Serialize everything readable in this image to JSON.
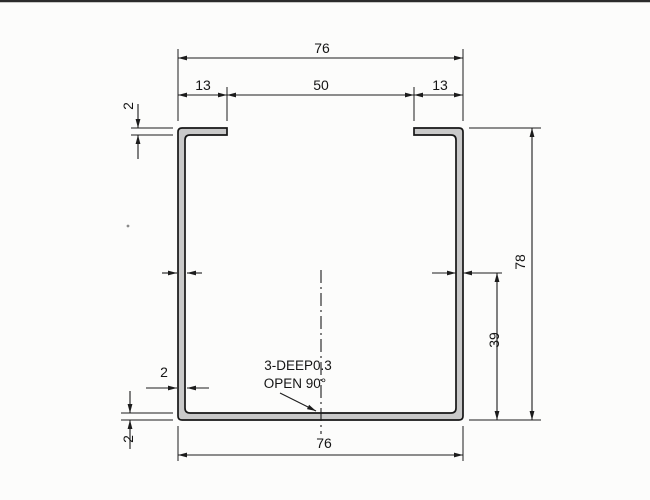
{
  "drawing": {
    "dimensions": {
      "top_width": "76",
      "top_left_lip": "13",
      "top_opening": "50",
      "top_right_lip": "13",
      "top_flange_thickness": "2",
      "left_wall_thickness": "2",
      "bottom_flange_thickness": "2",
      "overall_height": "78",
      "half_height": "39",
      "bottom_width": "76"
    },
    "note": {
      "line1": "3-DEEP0.3",
      "line2": "OPEN 90°"
    },
    "colors": {
      "line": "#1c1c1c",
      "profile_fill": "#c9c9c9",
      "background": "#fcfcfb"
    }
  }
}
